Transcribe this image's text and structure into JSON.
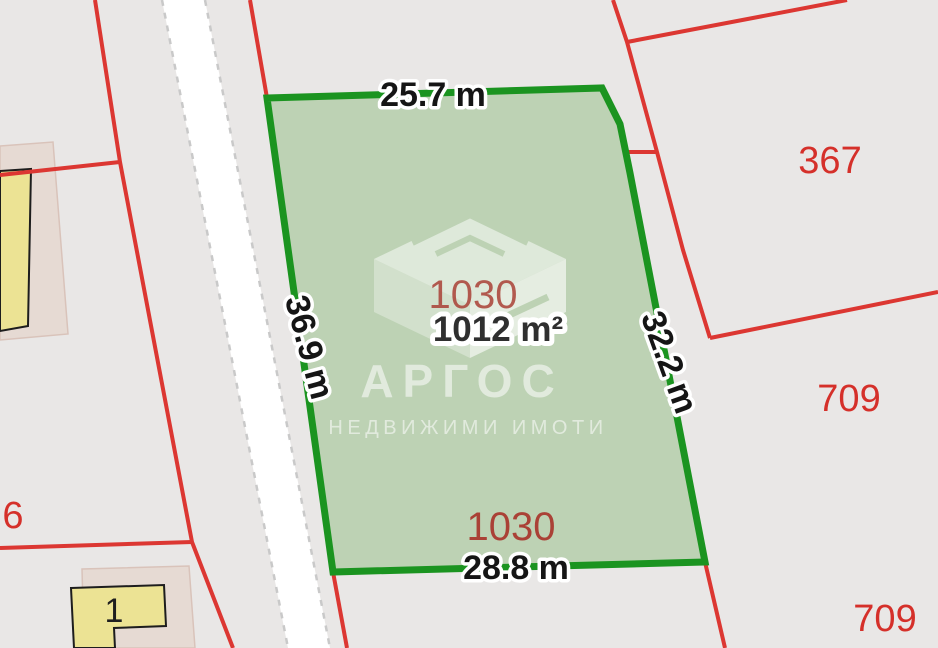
{
  "parcel": {
    "number": "1030",
    "number_bottom": "1030",
    "area": "1012 m²",
    "dim_top": "25.7 m",
    "dim_left": "36.9 m",
    "dim_right": "32.2 m",
    "dim_bottom": "28.8 m"
  },
  "adjacent_parcels": {
    "top_right": "367",
    "right": "709",
    "bottom_right": "709",
    "left_edge": "6"
  },
  "buildings": {
    "bottom_building_number": "1"
  },
  "watermark": {
    "brand": "АРГОС",
    "tagline": "НЕДВИЖИМИ ИМОТИ",
    "logo": "isometric-package-icon"
  },
  "colors": {
    "background": "#e9e7e6",
    "parcel_fill": "#bdd2b4",
    "parcel_border": "#1b9420",
    "boundary_line": "#dc3732",
    "adjacent_label_red": "#d5302a",
    "parcel_number_red": "#aa4136",
    "road_fill": "#ffffff",
    "building_fill": "#ece394",
    "building_block_fill": "#e6dad3"
  }
}
